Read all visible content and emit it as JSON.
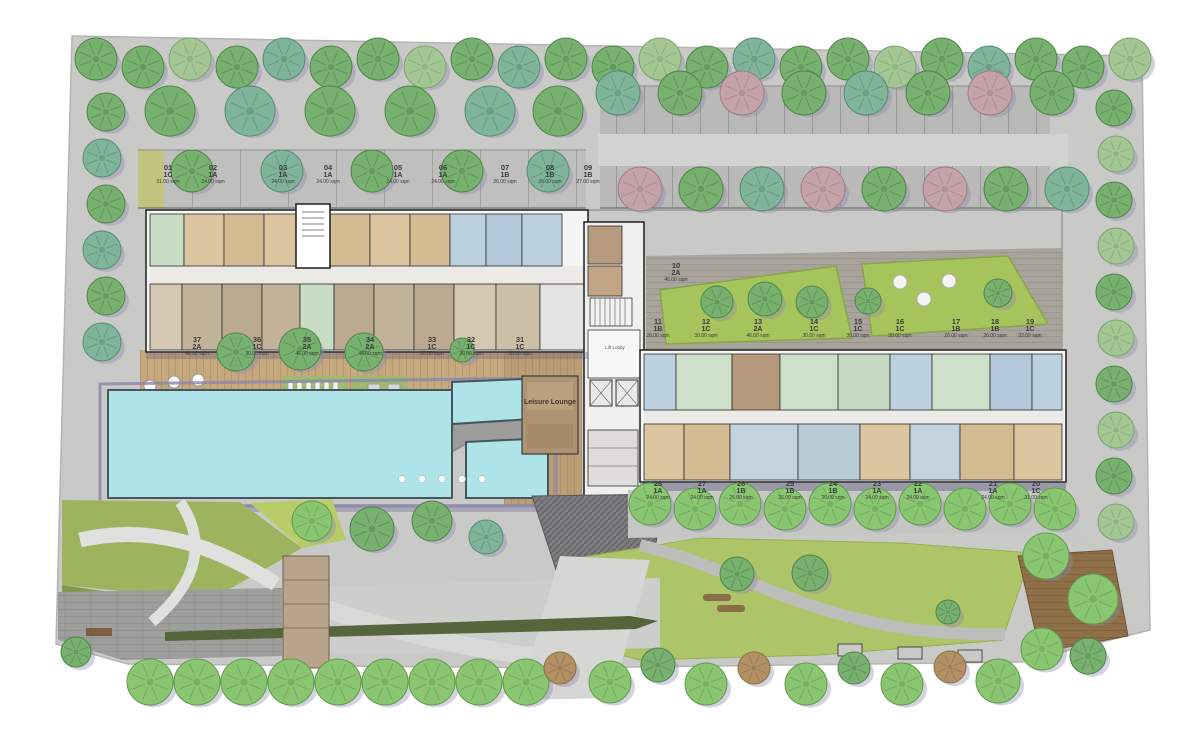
{
  "plan": {
    "lift_lobby_label": "Lift Lobby",
    "leisure_lounge_label": "Leisure Lounge"
  },
  "colors": {
    "site_concrete": "#c9c9c7",
    "parking_stall": "#b9b9b7",
    "pool_water": "#aee3e8",
    "pool_edge": "#46565e",
    "lawn_green": "#a6c45c",
    "lawn_olive": "#9db35e",
    "wood_deck": "#c6a87e",
    "wood_deck_dark": "#8f6f48",
    "hedge_green": "#86a35a",
    "tree_green": "#77b06f",
    "tree_bright_green": "#8ac672",
    "tree_teal": "#7fb49b",
    "tree_pink": "#c4a3a8",
    "tree_brown": "#b29064",
    "unit_tan": "#dcc6a0",
    "unit_khaki": "#c3b29a",
    "unit_green": "#cfe0ca",
    "unit_blue": "#bcd0de",
    "unit_brown": "#b5997b",
    "shadow_purple": "#8d89ad"
  },
  "unit_rows": {
    "top_row": [
      {
        "no": "01",
        "type": "1C",
        "area": "31.00 sqm"
      },
      {
        "no": "02",
        "type": "1A",
        "area": "24.00 sqm"
      },
      {
        "no": "03",
        "type": "1A",
        "area": "24.00 sqm"
      },
      {
        "no": "04",
        "type": "1A",
        "area": "24.00 sqm"
      },
      {
        "no": "05",
        "type": "1A",
        "area": "24.00 sqm"
      },
      {
        "no": "06",
        "type": "1A",
        "area": "24.00 sqm"
      },
      {
        "no": "07",
        "type": "1B",
        "area": "26.00 sqm"
      },
      {
        "no": "08",
        "type": "1B",
        "area": "26.00 sqm"
      },
      {
        "no": "09",
        "type": "1B",
        "area": "27.00 sqm"
      }
    ],
    "garden_unit": {
      "no": "10",
      "type": "2A",
      "area": "46.00 sqm"
    },
    "garden_row": [
      {
        "no": "11",
        "type": "1B",
        "area": "26.00 sqm"
      },
      {
        "no": "12",
        "type": "1C",
        "area": "30.00 sqm"
      },
      {
        "no": "13",
        "type": "2A",
        "area": "46.00 sqm"
      },
      {
        "no": "14",
        "type": "1C",
        "area": "30.00 sqm"
      },
      {
        "no": "15",
        "type": "1C",
        "area": "30.00 sqm"
      },
      {
        "no": "16",
        "type": "1C",
        "area": "30.00 sqm"
      },
      {
        "no": "17",
        "type": "1B",
        "area": "26.00 sqm"
      },
      {
        "no": "18",
        "type": "1B",
        "area": "26.00 sqm"
      },
      {
        "no": "19",
        "type": "1C",
        "area": "32.00 sqm"
      }
    ],
    "deck_row": [
      {
        "no": "37",
        "type": "2A",
        "area": "46.00 sqm"
      },
      {
        "no": "36",
        "type": "1C",
        "area": "30.00 sqm"
      },
      {
        "no": "35",
        "type": "2A",
        "area": "46.00 sqm"
      },
      {
        "no": "34",
        "type": "2A",
        "area": "46.00 sqm"
      },
      {
        "no": "33",
        "type": "1C",
        "area": "30.00 sqm"
      },
      {
        "no": "32",
        "type": "1C",
        "area": "30.00 sqm"
      },
      {
        "no": "31",
        "type": "1C",
        "area": "30.00 sqm"
      }
    ],
    "bottom_row": [
      {
        "no": "28",
        "type": "1A",
        "area": "24.00 sqm"
      },
      {
        "no": "27",
        "type": "1A",
        "area": "24.00 sqm"
      },
      {
        "no": "26",
        "type": "1B",
        "area": "26.00 sqm"
      },
      {
        "no": "25",
        "type": "1B",
        "area": "26.00 sqm"
      },
      {
        "no": "24",
        "type": "1B",
        "area": "26.00 sqm"
      },
      {
        "no": "23",
        "type": "1A",
        "area": "24.00 sqm"
      },
      {
        "no": "22",
        "type": "1A",
        "area": "24.00 sqm"
      },
      {
        "no": "21",
        "type": "1A",
        "area": "24.00 sqm"
      },
      {
        "no": "20",
        "type": "1C",
        "area": "31.00 sqm"
      }
    ]
  }
}
